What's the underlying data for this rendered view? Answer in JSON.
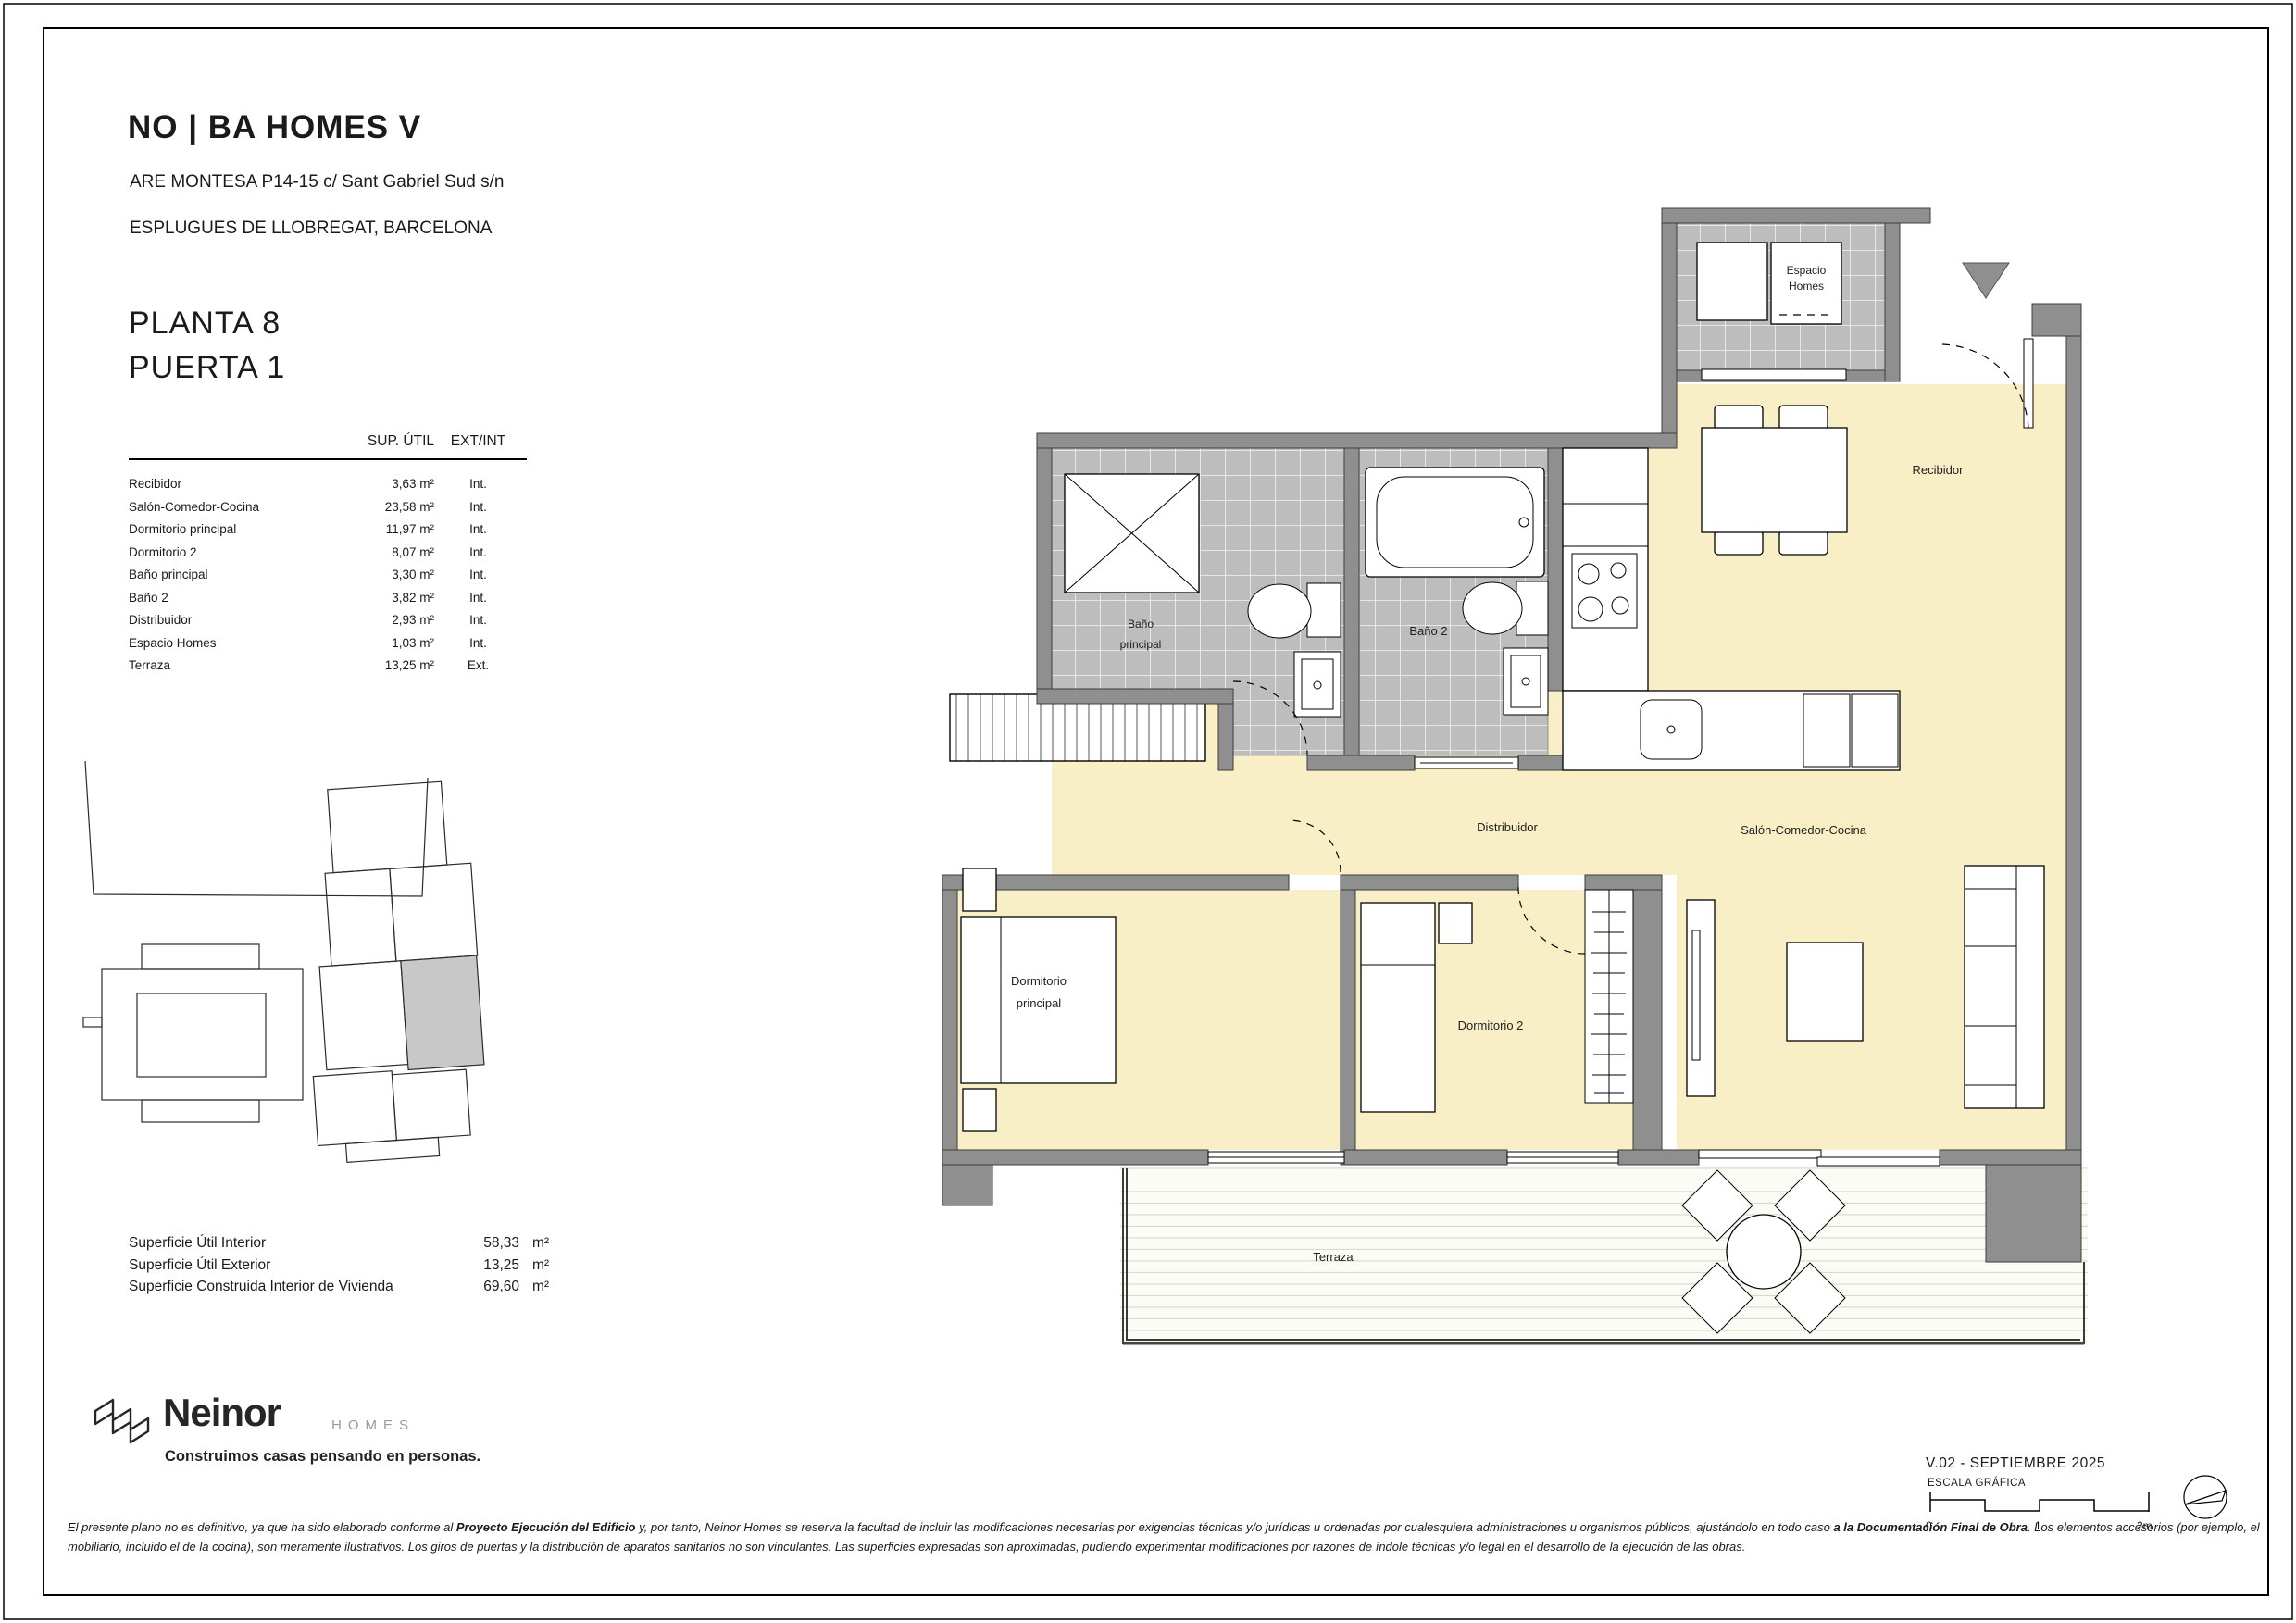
{
  "header": {
    "project": "NO | BA HOMES V",
    "address_line1": "ARE MONTESA P14-15 c/ Sant Gabriel Sud s/n",
    "address_line2": "ESPLUGUES DE LLOBREGAT, BARCELONA",
    "planta": "PLANTA 8",
    "puerta": "PUERTA 1"
  },
  "areas_table": {
    "col_sup": "SUP. ÚTIL",
    "col_extint": "EXT/INT",
    "rows": [
      {
        "name": "Recibidor",
        "value": "3,63 m²",
        "type": "Int."
      },
      {
        "name": "Salón-Comedor-Cocina",
        "value": "23,58 m²",
        "type": "Int."
      },
      {
        "name": "Dormitorio principal",
        "value": "11,97 m²",
        "type": "Int."
      },
      {
        "name": "Dormitorio 2",
        "value": "8,07 m²",
        "type": "Int."
      },
      {
        "name": "Baño principal",
        "value": "3,30 m²",
        "type": "Int."
      },
      {
        "name": "Baño 2",
        "value": "3,82 m²",
        "type": "Int."
      },
      {
        "name": "Distribuidor",
        "value": "2,93 m²",
        "type": "Int."
      },
      {
        "name": "Espacio Homes",
        "value": "1,03 m²",
        "type": "Int."
      },
      {
        "name": "Terraza",
        "value": "13,25 m²",
        "type": "Ext."
      }
    ]
  },
  "summary": {
    "rows": [
      {
        "label": "Superficie Útil Interior",
        "value": "58,33",
        "unit": "m²"
      },
      {
        "label": "Superficie Útil Exterior",
        "value": "13,25",
        "unit": "m²"
      },
      {
        "label": "Superficie Construida Interior de Vivienda",
        "value": "69,60",
        "unit": "m²"
      }
    ]
  },
  "plan": {
    "labels": {
      "espacio_line1": "Espacio",
      "espacio_line2": "Homes",
      "recibidor": "Recibidor",
      "bano_principal_line1": "Baño",
      "bano_principal_line2": "principal",
      "bano2": "Baño 2",
      "distribuidor": "Distribuidor",
      "salon": "Salón-Comedor-Cocina",
      "dormitorio_principal_line1": "Dormitorio",
      "dormitorio_principal_line2": "principal",
      "dormitorio2": "Dormitorio 2",
      "terraza": "Terraza"
    }
  },
  "titleblock": {
    "version": "V.02 - SEPTIEMBRE 2025",
    "escala": "ESCALA GRÁFICA",
    "scale_ticks": [
      "0",
      "1",
      "2m"
    ]
  },
  "logo": {
    "brand": "Neinor",
    "homes": "HOMES",
    "tagline": "Construimos casas pensando en personas."
  },
  "disclaimer": {
    "seg1": "El presente plano no es definitivo, ya que ha sido elaborado conforme al ",
    "seg2_bold": "Proyecto Ejecución del Edificio",
    "seg3": " y, por tanto, Neinor Homes se reserva la facultad de incluir las modificaciones necesarias por exigencias técnicas y/o jurídicas u ordenadas por cualesquiera administraciones u organismos públicos, ajustándolo en todo caso ",
    "seg4_bold": "a la Documentación Final de Obra",
    "seg5": ". Los elementos accesorios (por ejemplo, el mobiliario, incluido el de la cocina), son meramente ilustrativos. Los giros de puertas y la distribución de aparatos sanitarios no son vinculantes. Las superficies expresadas son aproximadas, pudiendo experimentar modificaciones por razones de índole técnicas y/o legal en el desarrollo de la ejecución de las obras."
  },
  "colors": {
    "floor": "#F9EFC6",
    "wall": "#8F8F8F",
    "tile": "#BDBDBD",
    "deck_line": "#D9D9CA"
  }
}
